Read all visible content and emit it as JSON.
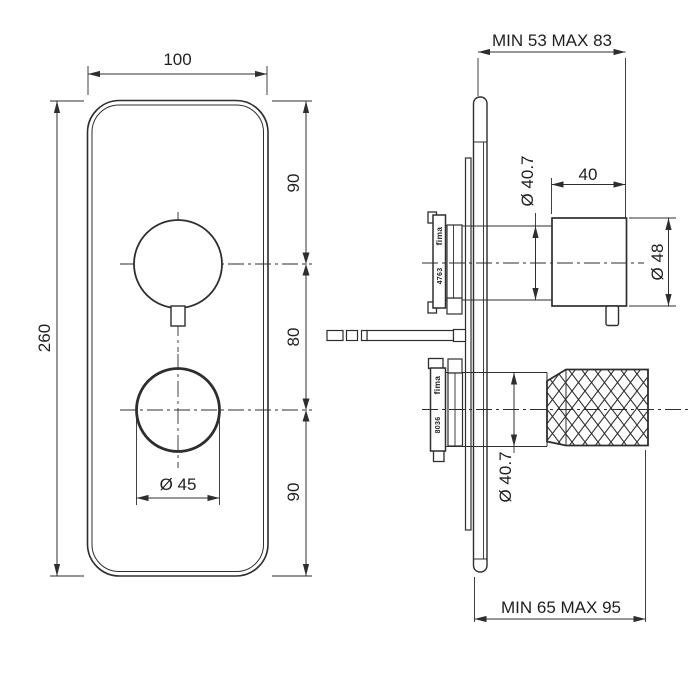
{
  "front_view": {
    "plate_width": "100",
    "plate_height": "260",
    "segment_top": "90",
    "segment_middle": "80",
    "segment_bottom": "90",
    "lower_knob_diameter": "Ø 45"
  },
  "side_view": {
    "upper_projection": "MIN 53 MAX 83",
    "lower_projection": "MIN 65 MAX 95",
    "upper_shaft_diameter": "Ø 40.7",
    "upper_knob_length": "40",
    "upper_knob_diameter": "Ø 48",
    "lower_shaft_diameter": "Ø 40.7",
    "upper_cartridge": {
      "brand": "fima",
      "code": "4763"
    },
    "lower_cartridge": {
      "brand": "fima",
      "code": "8036"
    }
  },
  "colors": {
    "line": "#2e2e2e",
    "text": "#1f1f1f",
    "background": "#ffffff"
  }
}
